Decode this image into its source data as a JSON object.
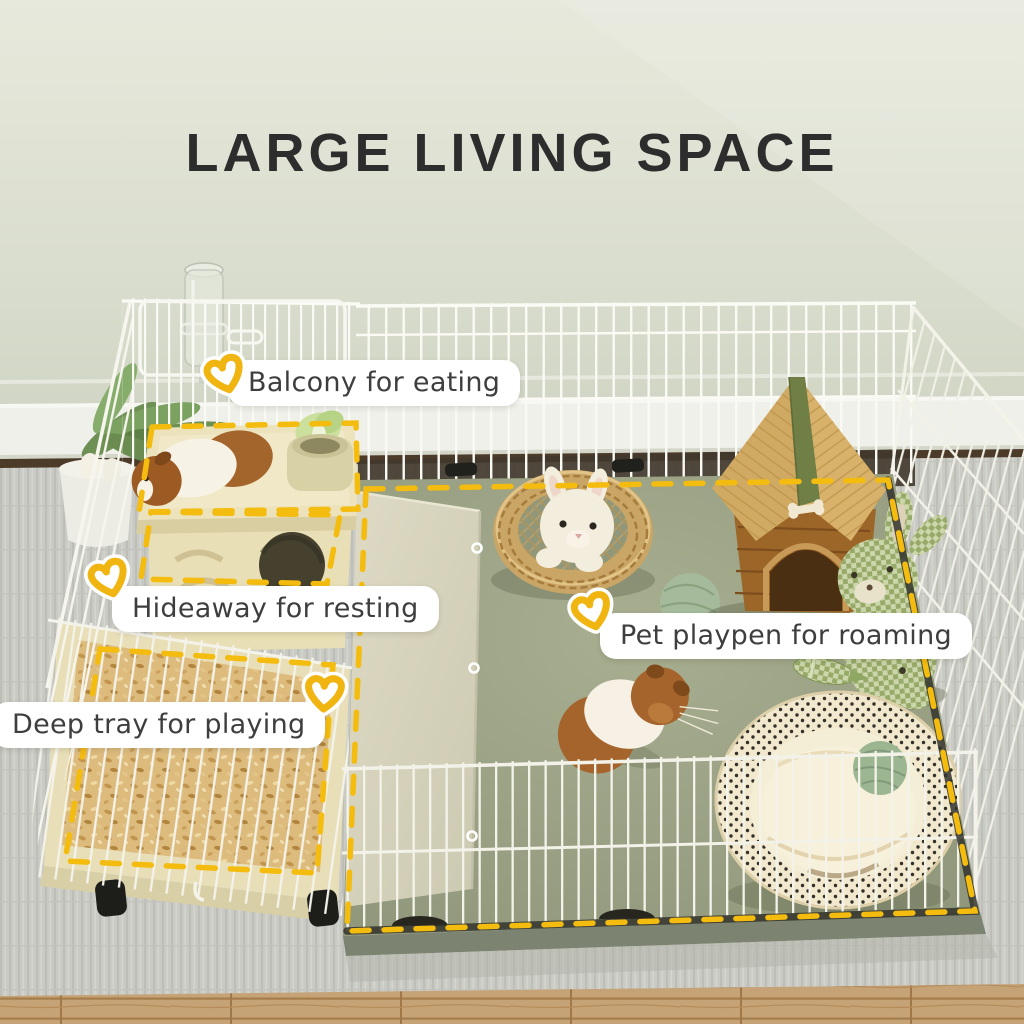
{
  "page": {
    "title": "LARGE LIVING SPACE"
  },
  "annotations": {
    "balcony": "Balcony for eating",
    "hideaway": "Hideaway for resting",
    "deep_tray": "Deep tray for playing",
    "playpen": "Pet playpen for roaming"
  },
  "icons": [
    {
      "name": "heart-doodle-icon",
      "style": "hand-drawn open heart",
      "color": "#f1b511",
      "casing": "#ffffff",
      "count": 4
    }
  ],
  "colors": {
    "title_text": "#2d2d2d",
    "label_text": "#3e3e3e",
    "label_background": "#ffffff",
    "highlight_dash_yellow": "#f4bc0e",
    "heart_yellow": "#f1b511",
    "wall_sage": "#dde1d2",
    "baseboard_white": "#eff0ea",
    "carpet_gray": "#c8c9c3",
    "wood_floor": "#c3a072",
    "mat_green": "#9aa083",
    "wire_white": "#f6f5ee",
    "cream_furniture": "#eae0ba",
    "bedding_tan": "#ddbb7d",
    "dog_house_wood": "#d2ac65",
    "dog_house_body": "#9c6628",
    "ridge_green": "#6f7f46",
    "gingham_green": "#98aa69"
  },
  "scene": {
    "setting": [
      "sage-wall",
      "white-baseboard",
      "gray-carpet",
      "wood-floor"
    ],
    "objects": [
      "white-wire-playpen",
      "green-floor-mat",
      "water-bottle",
      "potted-plant",
      "guinea-pig-on-balcony",
      "food-bowl-with-lettuce",
      "hideaway-house",
      "deep-bedding-tray",
      "caster-wheels",
      "fabric-divider-panel",
      "wicker-basket",
      "plush-rabbit",
      "yarn-ball",
      "wooden-pet-house",
      "gingham-plush-bunny",
      "celery-toy",
      "guinea-pig-on-mat",
      "polka-dot-pet-bed",
      "yarn-ball-in-bed"
    ]
  }
}
